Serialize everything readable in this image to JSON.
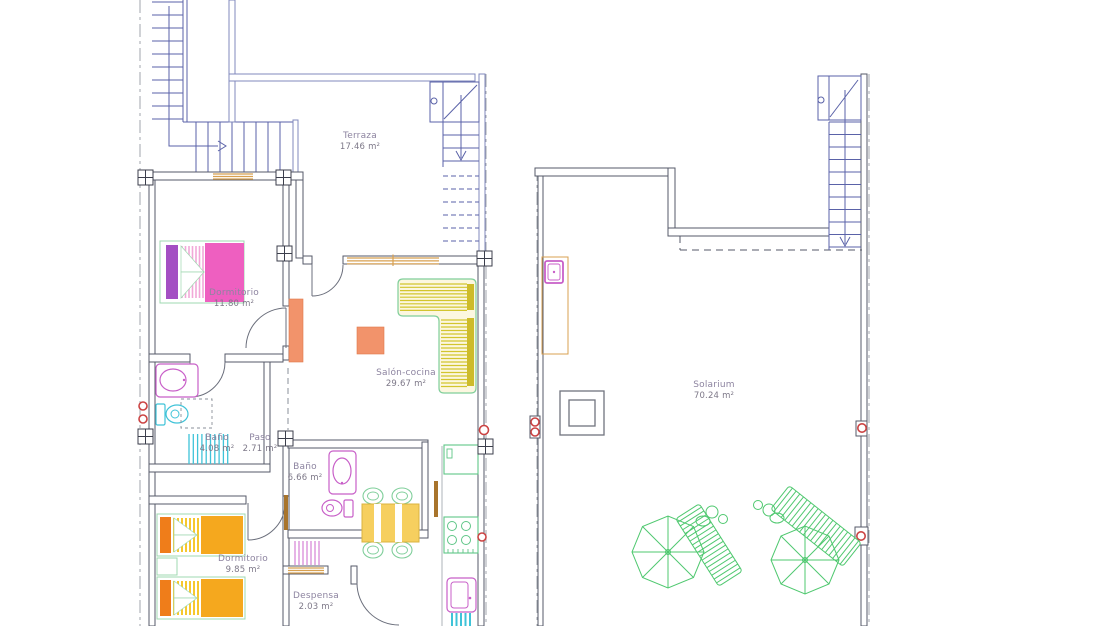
{
  "document": {
    "type": "architectural-floor-plan",
    "sheets": [
      "apartment floor",
      "roof solarium"
    ]
  },
  "rooms": [
    {
      "id": "terraza",
      "name": "Terraza",
      "area": "17.46 m²"
    },
    {
      "id": "dormitorio-1",
      "name": "Dormitorio",
      "area": "11.80 m²"
    },
    {
      "id": "salon-cocina",
      "name": "Salón-cocina",
      "area": "29.67 m²"
    },
    {
      "id": "bano-1",
      "name": "Baño",
      "area": "4.08 m²"
    },
    {
      "id": "paso",
      "name": "Paso",
      "area": "2.71 m²"
    },
    {
      "id": "bano-2",
      "name": "Baño",
      "area": "6.66 m²"
    },
    {
      "id": "dormitorio-2",
      "name": "Dormitorio",
      "area": "9.85 m²"
    },
    {
      "id": "despensa",
      "name": "Despensa",
      "area": "2.03 m²"
    },
    {
      "id": "solarium",
      "name": "Solarium",
      "area": "70.24 m²"
    }
  ],
  "palette": {
    "walls": "#565a68",
    "stairs_blue": "#5a62a8",
    "terrace_walls": "#8088bc",
    "wood_tan": "#d8a050",
    "door_leaf_brown": "#a8742c",
    "furniture_green": "#7fce9a",
    "lounger_green": "#4fc86f",
    "fixture_magenta": "#c85fc8",
    "fixture_cyan": "#3fc3d8",
    "bed_pink": "#ee5fc0",
    "bed_purple": "#a44fc3",
    "bed_orange": "#f5a81e",
    "headboard_orange": "#ef7d1a",
    "sofa_stripe_yellow": "#d2c52e",
    "table_yellow": "#f6cf5f",
    "salmon": "#f2936b",
    "marker_red": "#cb4343",
    "label_text": "#8d84a0"
  }
}
